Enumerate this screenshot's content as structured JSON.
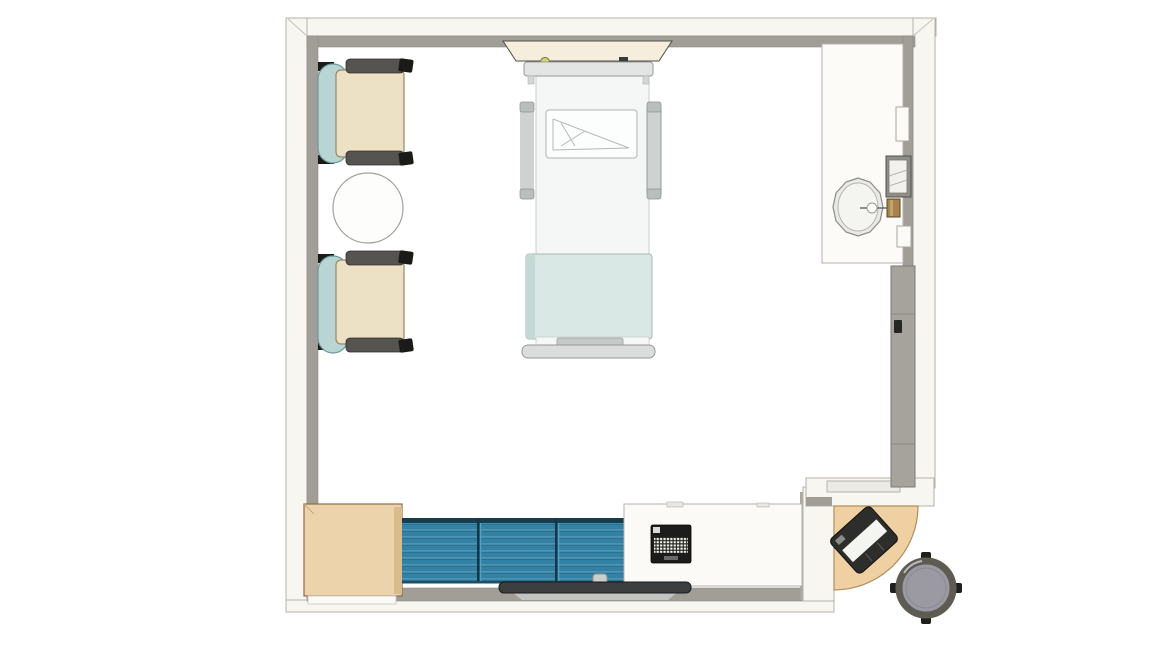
{
  "meta": {
    "scene": "hospital-patient-room-floor-plan",
    "view": "top-down-rendered-plan"
  },
  "colors": {
    "background": "#ffffff",
    "wall_fill": "#f8f6f1",
    "wall_face": "#a19e97",
    "wall_outline": "#b6b2ab",
    "chair_seat": "#ede1c5",
    "chair_back": "#b9d5d3",
    "chair_armrest": "#565450",
    "chair_foot": "#1a1a19",
    "table_top": "#fdfdfc",
    "headwall_panel": "#f5eedd",
    "headwall_light": "#ced674",
    "bed_frame": "#e3e5e4",
    "mattress": "#f4f7f6",
    "pillow": "#fcfdfd",
    "blanket": "#d9e8e4",
    "blanket_edge": "#c4d9d5",
    "bed_rail": "#ced2d1",
    "footboard": "#dbdddc",
    "counter": "#fcfbf8",
    "sink_rim": "#e9e9e5",
    "sink_bowl": "#f4f4f1",
    "faucet": "#a5824f",
    "dispenser_body": "#8f8e89",
    "dispenser_face": "#f2f1ee",
    "sliding_door": "#a6a39c",
    "door_handle": "#262624",
    "wardrobe": "#ecd3ab",
    "wardrobe_side": "#d9bb8e",
    "bench": "#3382a5",
    "bench_edge": "#173c4e",
    "desk": "#fbfaf7",
    "keyboard": "#1c1c1a",
    "keyboard_keys": "#f2f2ee",
    "tv": "#3c3e40",
    "tv_mount": "#cdcfcd",
    "tv_shadow": "#c2c4c2",
    "corner_desk": "#eed0a3",
    "corner_keyboard": "#2d2d2b",
    "corner_keyboard_paper": "#f4f4f0",
    "stool_seat": "#9b99a2",
    "stool_ring": "#5e5c52",
    "stool_caster": "#1f1f1d"
  },
  "legend": {
    "room": "patient room",
    "guest_chair_1": "guest chair",
    "guest_chair_2": "guest chair",
    "side_table": "round side table",
    "patient_bed": "patient bed with rails",
    "headwall": "headwall service panel",
    "vanity": "sink counter",
    "sink": "round sink with faucet",
    "towel_dispenser": "paper towel dispenser",
    "sliding_door": "sliding entry door",
    "wardrobe": "wardrobe cabinet",
    "bench": "upholstered window bench",
    "footwall_desk": "footwall work counter",
    "keyboard": "keyboard",
    "tv": "wall mounted tv",
    "corner_workstation": "corner charting desk with keyboard",
    "stool": "rolling stool"
  }
}
